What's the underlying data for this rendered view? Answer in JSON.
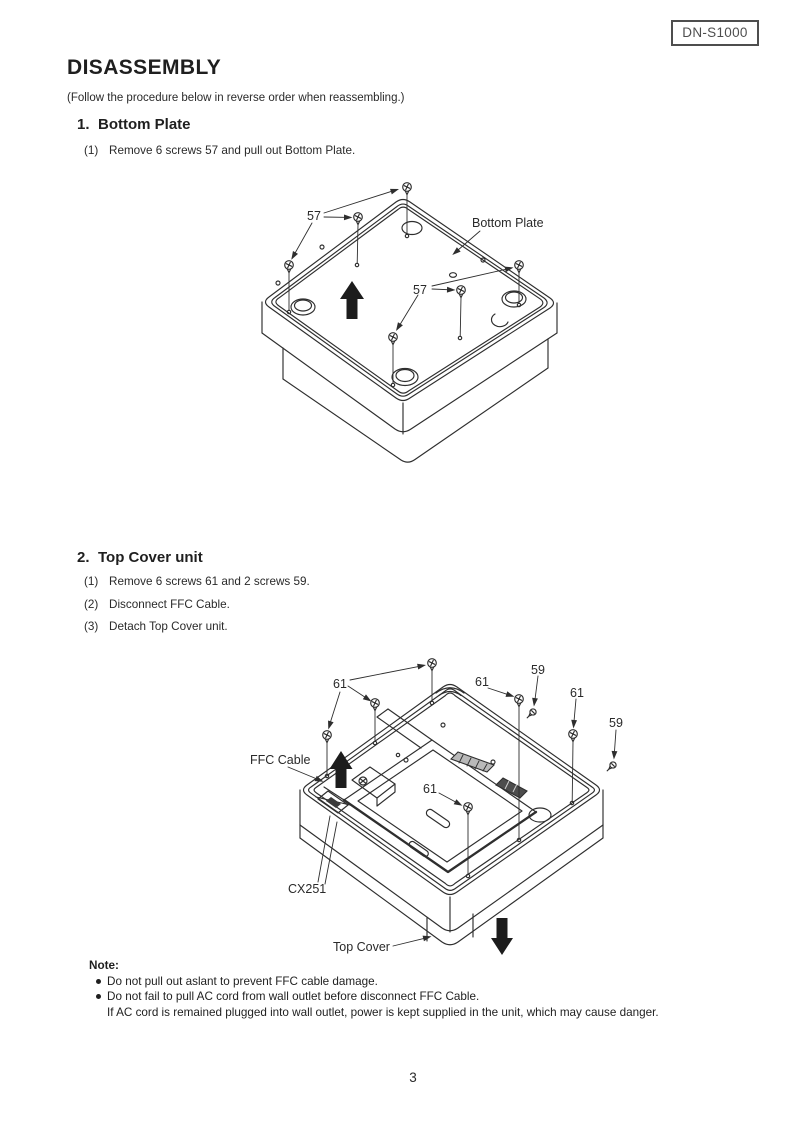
{
  "page": {
    "model_badge": "DN-S1000",
    "page_number": "3"
  },
  "heading": {
    "title": "DISASSEMBLY",
    "subtitle": "(Follow the procedure below in reverse order when reassembling.)"
  },
  "sections": [
    {
      "label": "1.",
      "title": "Bottom Plate",
      "steps": [
        {
          "num": "(1)",
          "text": "Remove 6 screws 57 and pull out Bottom Plate."
        }
      ]
    },
    {
      "label": "2.",
      "title": "Top Cover unit",
      "steps": [
        {
          "num": "(1)",
          "text": "Remove 6 screws 61 and 2 screws 59."
        },
        {
          "num": "(2)",
          "text": "Disconnect FFC Cable."
        },
        {
          "num": "(3)",
          "text": "Detach Top Cover unit."
        }
      ]
    }
  ],
  "diagram1": {
    "labels": {
      "screws_top": "57",
      "screws_mid": "57",
      "bottom_plate": "Bottom Plate"
    }
  },
  "diagram2": {
    "labels": {
      "l61_a": "61",
      "l61_b": "61",
      "l61_c": "61",
      "l61_d": "61",
      "l59_a": "59",
      "l59_b": "59",
      "ffc_cable": "FFC Cable",
      "cx251": "CX251",
      "top_cover": "Top Cover"
    }
  },
  "note": {
    "title": "Note:",
    "bullets": [
      "Do not pull out aslant to prevent FFC cable damage.",
      "Do not fail to pull AC cord from wall outlet before disconnect FFC Cable."
    ],
    "continuation": "If AC cord is remained plugged into wall outlet, power is kept supplied in the unit, which may cause danger."
  }
}
